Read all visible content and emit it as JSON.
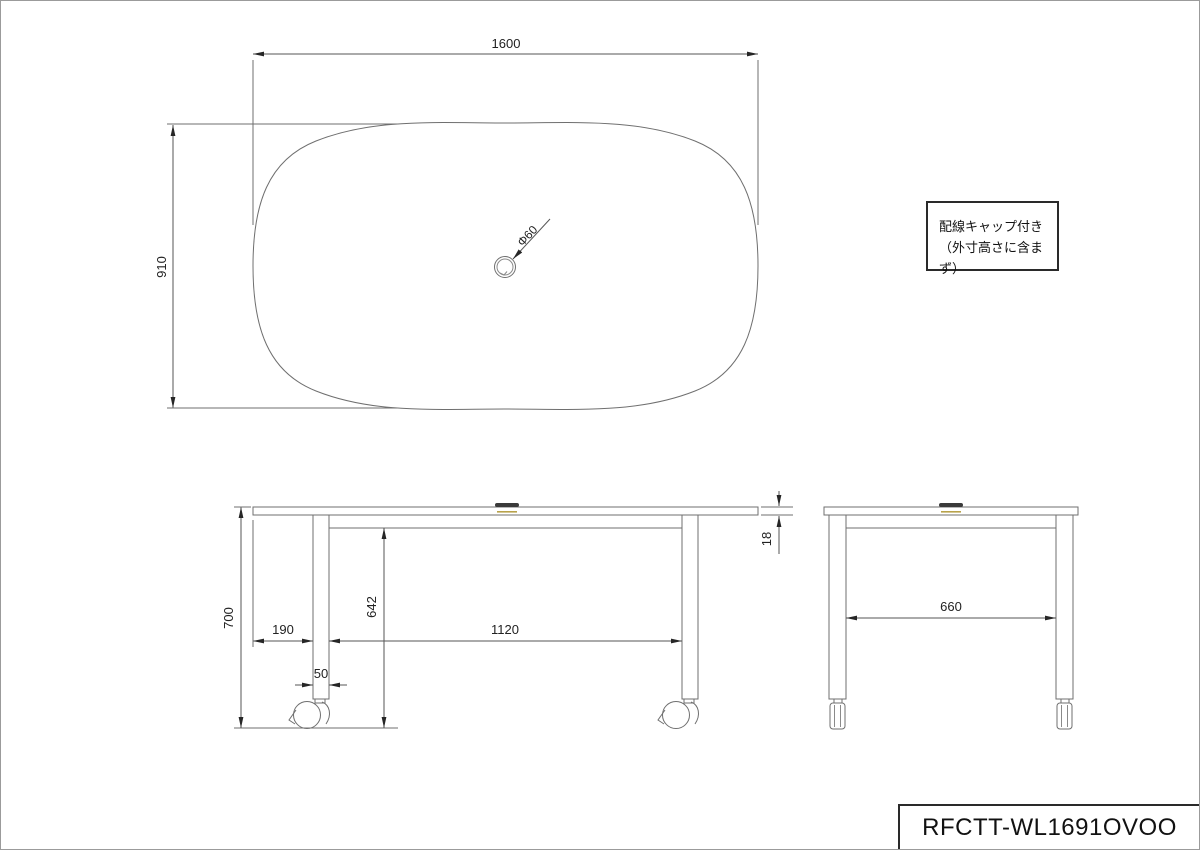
{
  "page": {
    "background": "#ffffff",
    "border_color": "#9b9b9b",
    "object_line_color": "#6f6f6f",
    "dimension_line_color": "#565656",
    "text_color": "#222222",
    "cap_dark_color": "#3a3a3a",
    "cap_accent_color": "#b8a24a"
  },
  "views": {
    "top": {
      "dims": {
        "width": "1600",
        "depth": "910",
        "hole_diameter": "Φ60"
      }
    },
    "front": {
      "dims": {
        "overall_height": "700",
        "edge_to_leg": "190",
        "leg_span": "1120",
        "leg_width": "50",
        "underside_height": "642",
        "top_thickness": "18"
      }
    },
    "side": {
      "dims": {
        "leg_span": "660"
      }
    }
  },
  "note_box": {
    "line1": "配線キャップ付き",
    "line2": "（外寸高さに含まず）"
  },
  "title_block": {
    "model": "RFCTT-WL1691OVOO"
  }
}
